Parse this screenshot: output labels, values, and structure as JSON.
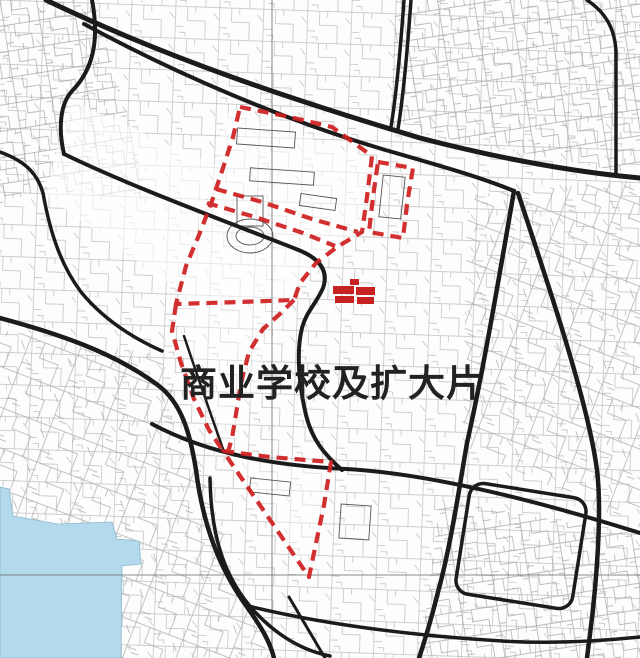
{
  "map": {
    "label": "商业学校及扩大片",
    "colors": {
      "boundary_red": "#cf1f1f",
      "highlight_red": "#c62222",
      "road_black": "#1b1b1b",
      "water_blue": "#b2d9ec",
      "label_black": "#222222",
      "grid_gray": "#666666",
      "background": "#fdfdfd"
    }
  }
}
